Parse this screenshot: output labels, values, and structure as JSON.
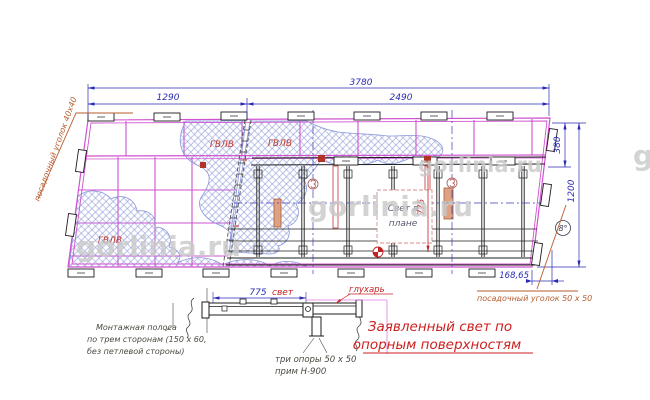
{
  "drawing": {
    "dims": {
      "overall": "3780",
      "left": "1290",
      "right": "2490",
      "height_top": "380",
      "height_full": "1200",
      "offset": "168,65",
      "angle": "8°",
      "plan_light": "775",
      "section_light_value": "775",
      "section_light_word": "свет"
    },
    "labels": {
      "panel1": "ГВЛВ",
      "panel2": "ГВЛВ",
      "panel3": "ГВЛВ",
      "seat_angle_left": "посадочный уголок 40х40",
      "seat_angle_right": "посадочный уголок 50 х 50",
      "lag_screw": "глухарь",
      "mount1": "Монтажная полоса",
      "mount2": "по трем сторонам (150 х 60,",
      "mount3": "без петлевой стороны)",
      "supports1": "три опоры 50 х 50",
      "supports2": "прим Н-900",
      "declared1": "Заявленный свет по",
      "declared2": "опорным поверхностям",
      "plan_box1": "Свет в",
      "plan_box2": "плане"
    },
    "watermark": "gorlinia.ru",
    "colors": {
      "grid_magenta": "#cf52cf",
      "dimension_blue": "#2a2ab5",
      "annotation_red": "#c42323",
      "leader_orange": "#b65c2e",
      "hatch_blue": "#8a97d8",
      "frame_black": "#1c1c1c",
      "watermark_gray": "#c9c9c9"
    }
  }
}
